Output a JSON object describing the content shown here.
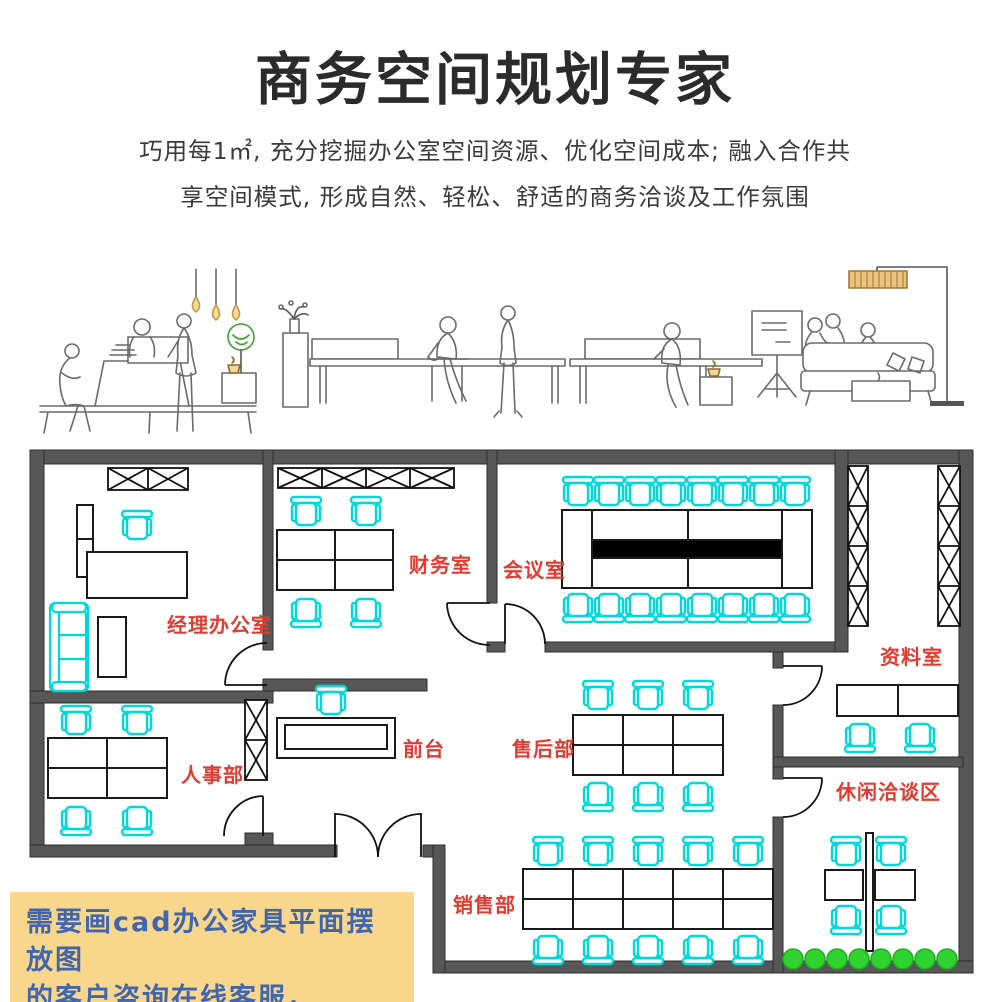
{
  "header": {
    "title": "商务空间规划专家",
    "subtitle_line1": "巧用每1㎡, 充分挖掘办公室空间资源、优化空间成本; 融入合作共",
    "subtitle_line2": "享空间模式, 形成自然、轻松、舒适的商务洽谈及工作氛围"
  },
  "illustration": {
    "icons": [
      "pendant-lamp",
      "plant",
      "bench-seating",
      "reception-cabinet",
      "flipchart",
      "sofa",
      "floor-lamp",
      "coffee-cup"
    ]
  },
  "plan": {
    "rooms": {
      "manager": "经理办公室",
      "finance": "财务室",
      "meeting": "会议室",
      "archive": "资料室",
      "hr": "人事部",
      "front_desk": "前台",
      "after_sales": "售后部",
      "leisure": "休闲洽谈区",
      "sales": "销售部"
    },
    "colors": {
      "wall": "#575757",
      "chair": "#00d9d9",
      "label": "#e23b30",
      "plant": "#2fd32f",
      "table_bar": "#000000"
    }
  },
  "note": {
    "line1": "需要画cad办公家具平面摆放图",
    "line2": "的客户咨询在线客服，",
    "bg": "#f8d78c",
    "text_color": "#4166ad"
  }
}
